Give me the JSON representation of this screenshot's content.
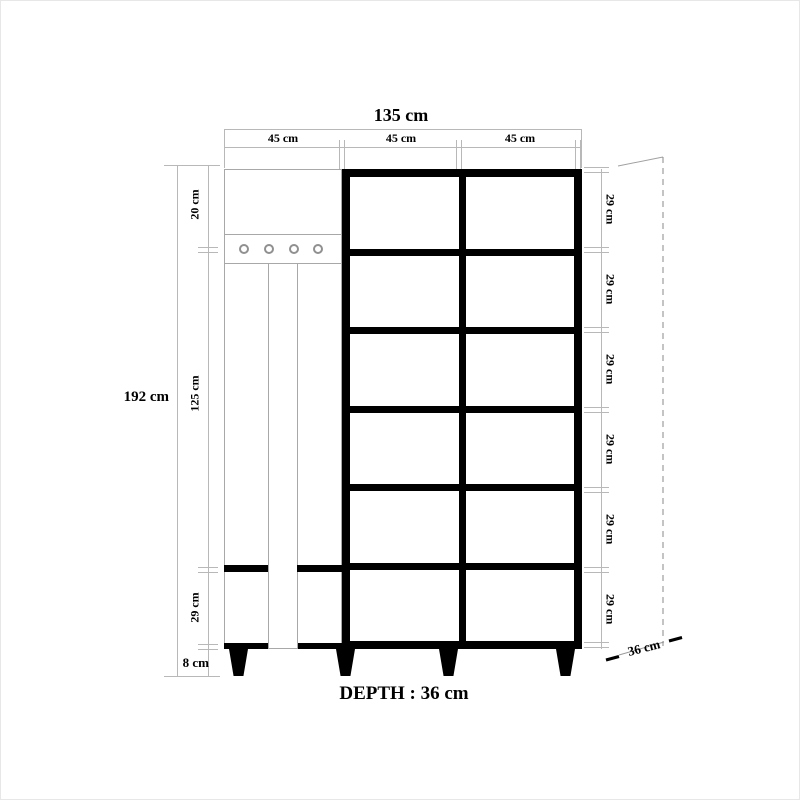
{
  "drawing": {
    "width_total": "135 cm",
    "width_columns": [
      "45 cm",
      "45 cm",
      "45 cm"
    ],
    "height_total": "192 cm",
    "height_left": {
      "top": "20 cm",
      "middle": "125 cm",
      "lower": "29 cm",
      "base": "8 cm"
    },
    "rows_right": [
      "29 cm",
      "29 cm",
      "29 cm",
      "29 cm",
      "29 cm",
      "29 cm"
    ],
    "depth_diagonal": "36 cm",
    "depth_note": "DEPTH : 36 cm"
  },
  "structure": {
    "grid_rows": 6,
    "grid_cols": 2,
    "hooks": 4,
    "legs": 4
  },
  "colors": {
    "ink": "#000000",
    "thin_line": "#a8a8a8",
    "dim_line": "#b8b8b8",
    "dash_line": "#888888"
  }
}
